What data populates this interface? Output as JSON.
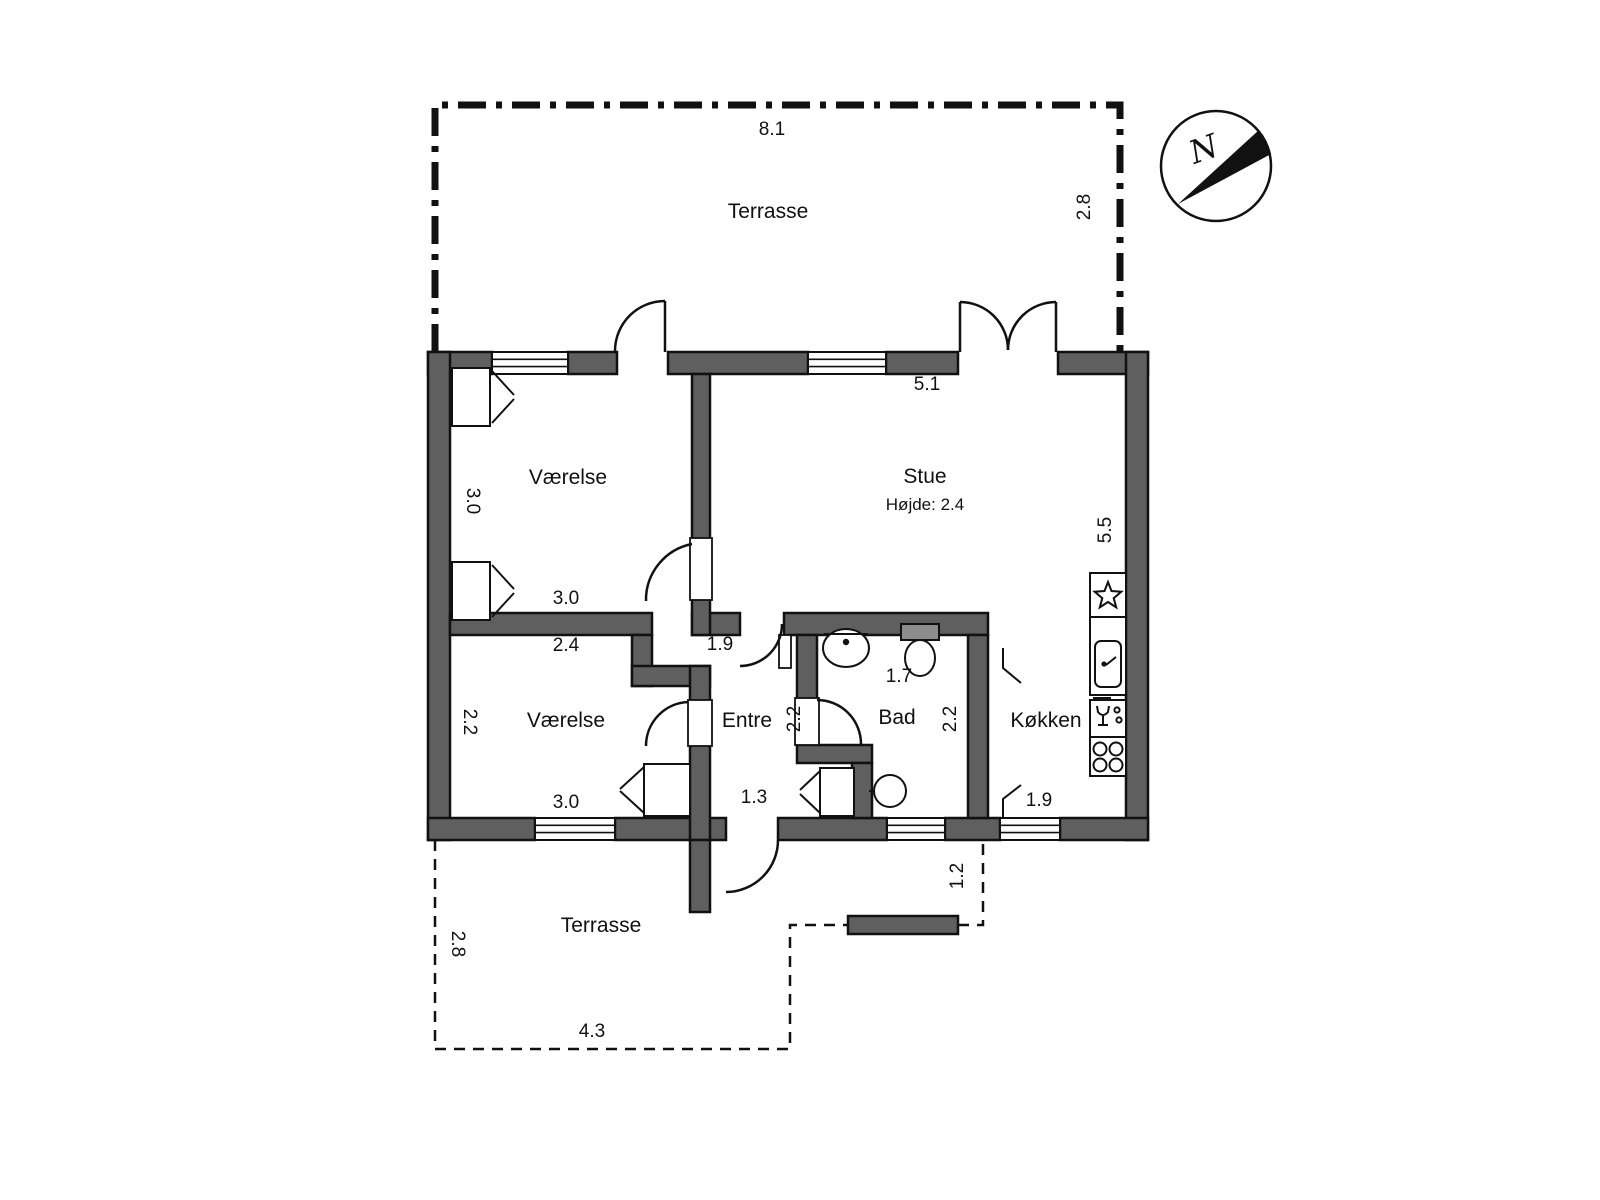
{
  "colors": {
    "wall": "#5f5f5f",
    "line": "#111111",
    "paper": "#ffffff"
  },
  "compass": {
    "north": "N"
  },
  "terrace_top": {
    "label": "Terrasse",
    "dim_width": "8.1",
    "dim_depth": "2.8"
  },
  "terrace_bottom": {
    "label": "Terrasse",
    "dim_width": "4.3",
    "dim_depth": "2.8",
    "dim_step": "1.2"
  },
  "rooms": {
    "bedroom_nw": {
      "label": "Værelse",
      "dim_side": "3.0",
      "dim_width": "3.0"
    },
    "bedroom_sw": {
      "label": "Værelse",
      "dim_top": "2.4",
      "dim_side": "2.2",
      "dim_width": "3.0"
    },
    "living": {
      "label": "Stue",
      "ceiling_note": "Højde: 2.4",
      "dim_width": "5.1",
      "dim_side": "5.5"
    },
    "hall": {
      "label": "Entre",
      "dim_top": "1.9",
      "dim_side": "2.2",
      "dim_door": "1.3"
    },
    "bath": {
      "label": "Bad",
      "dim_top": "1.7",
      "dim_side": "2.2"
    },
    "kitchen": {
      "label": "Køkken",
      "dim_width": "1.9"
    }
  }
}
